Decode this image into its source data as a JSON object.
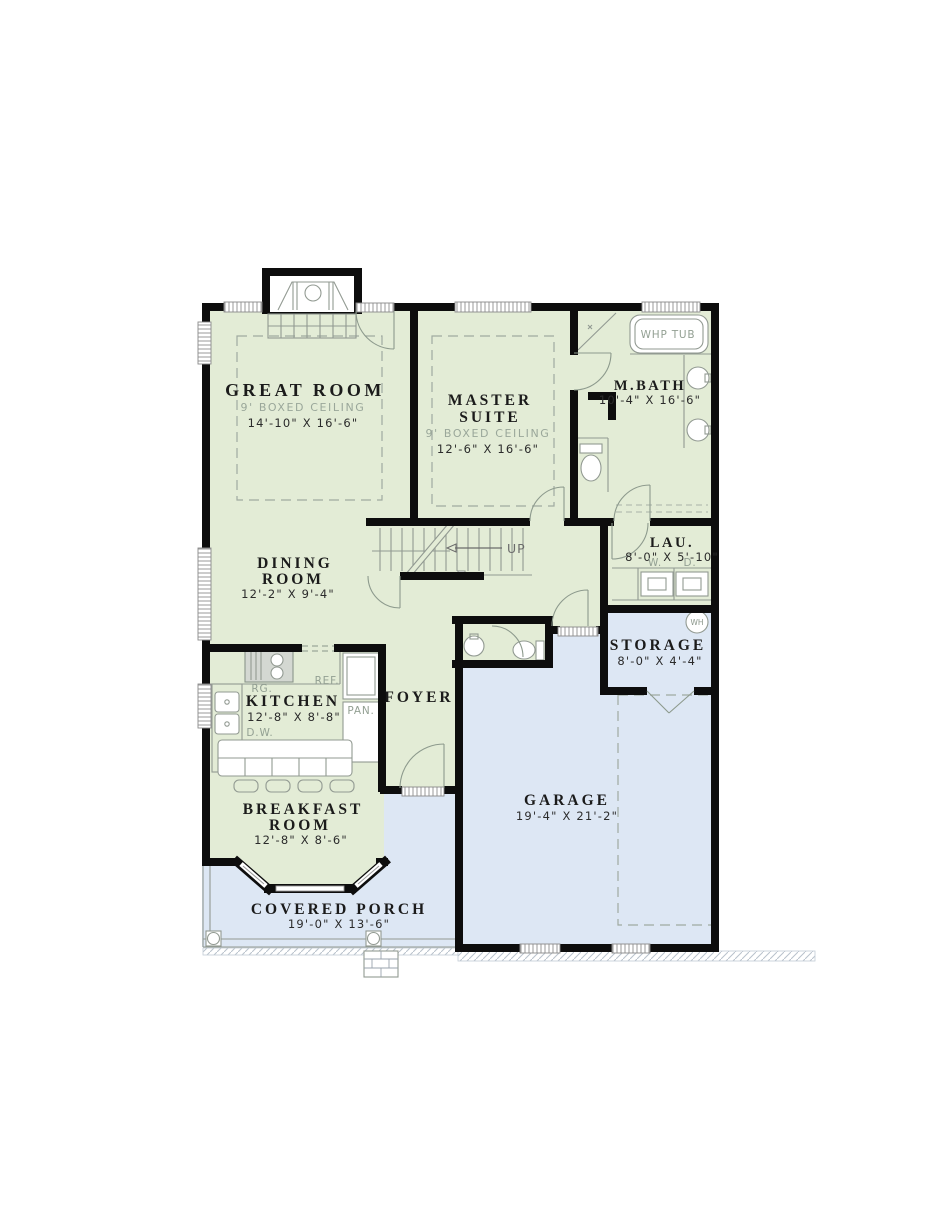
{
  "title": "First Floor Plan",
  "colors": {
    "living": "#e3ecd6",
    "garage": "#dde7f4",
    "wall": "#0d0d0d"
  },
  "rooms": {
    "great_room": {
      "name": "GREAT ROOM",
      "ceiling": "9' BOXED CEILING",
      "dims": "14'-10\" X 16'-6\""
    },
    "master_suite": {
      "line1": "MASTER",
      "line2": "SUITE",
      "ceiling": "9' BOXED CEILING",
      "dims": "12'-6\" X 16'-6\""
    },
    "master_bath": {
      "name": "M.BATH",
      "dims": "10'-4\" X 16'-6\""
    },
    "laundry": {
      "name": "LAU.",
      "dims": "8'-0\" X 5'-10\"",
      "washer": "W.",
      "dryer": "D."
    },
    "storage": {
      "name": "STORAGE",
      "dims": "8'-0\" X 4'-4\"",
      "water_heater": "WH"
    },
    "dining_room": {
      "line1": "DINING",
      "line2": "ROOM",
      "dims": "12'-2\" X 9'-4\""
    },
    "kitchen": {
      "name": "KITCHEN",
      "dims": "12'-8\" X 8'-8\"",
      "range": "RG.",
      "refrigerator": "REF.",
      "pantry": "PAN.",
      "dishwasher": "D.W."
    },
    "foyer": {
      "name": "FOYER"
    },
    "breakfast_room": {
      "line1": "BREAKFAST",
      "line2": "ROOM",
      "dims": "12'-8\" X 8'-6\""
    },
    "garage": {
      "name": "GARAGE",
      "dims": "19'-4\" X 21'-2\""
    },
    "covered_porch": {
      "name": "COVERED PORCH",
      "dims": "19'-0\" X 13'-6\""
    }
  },
  "fixtures": {
    "whirlpool_tub": "WHP TUB",
    "stairs_direction": "UP"
  }
}
